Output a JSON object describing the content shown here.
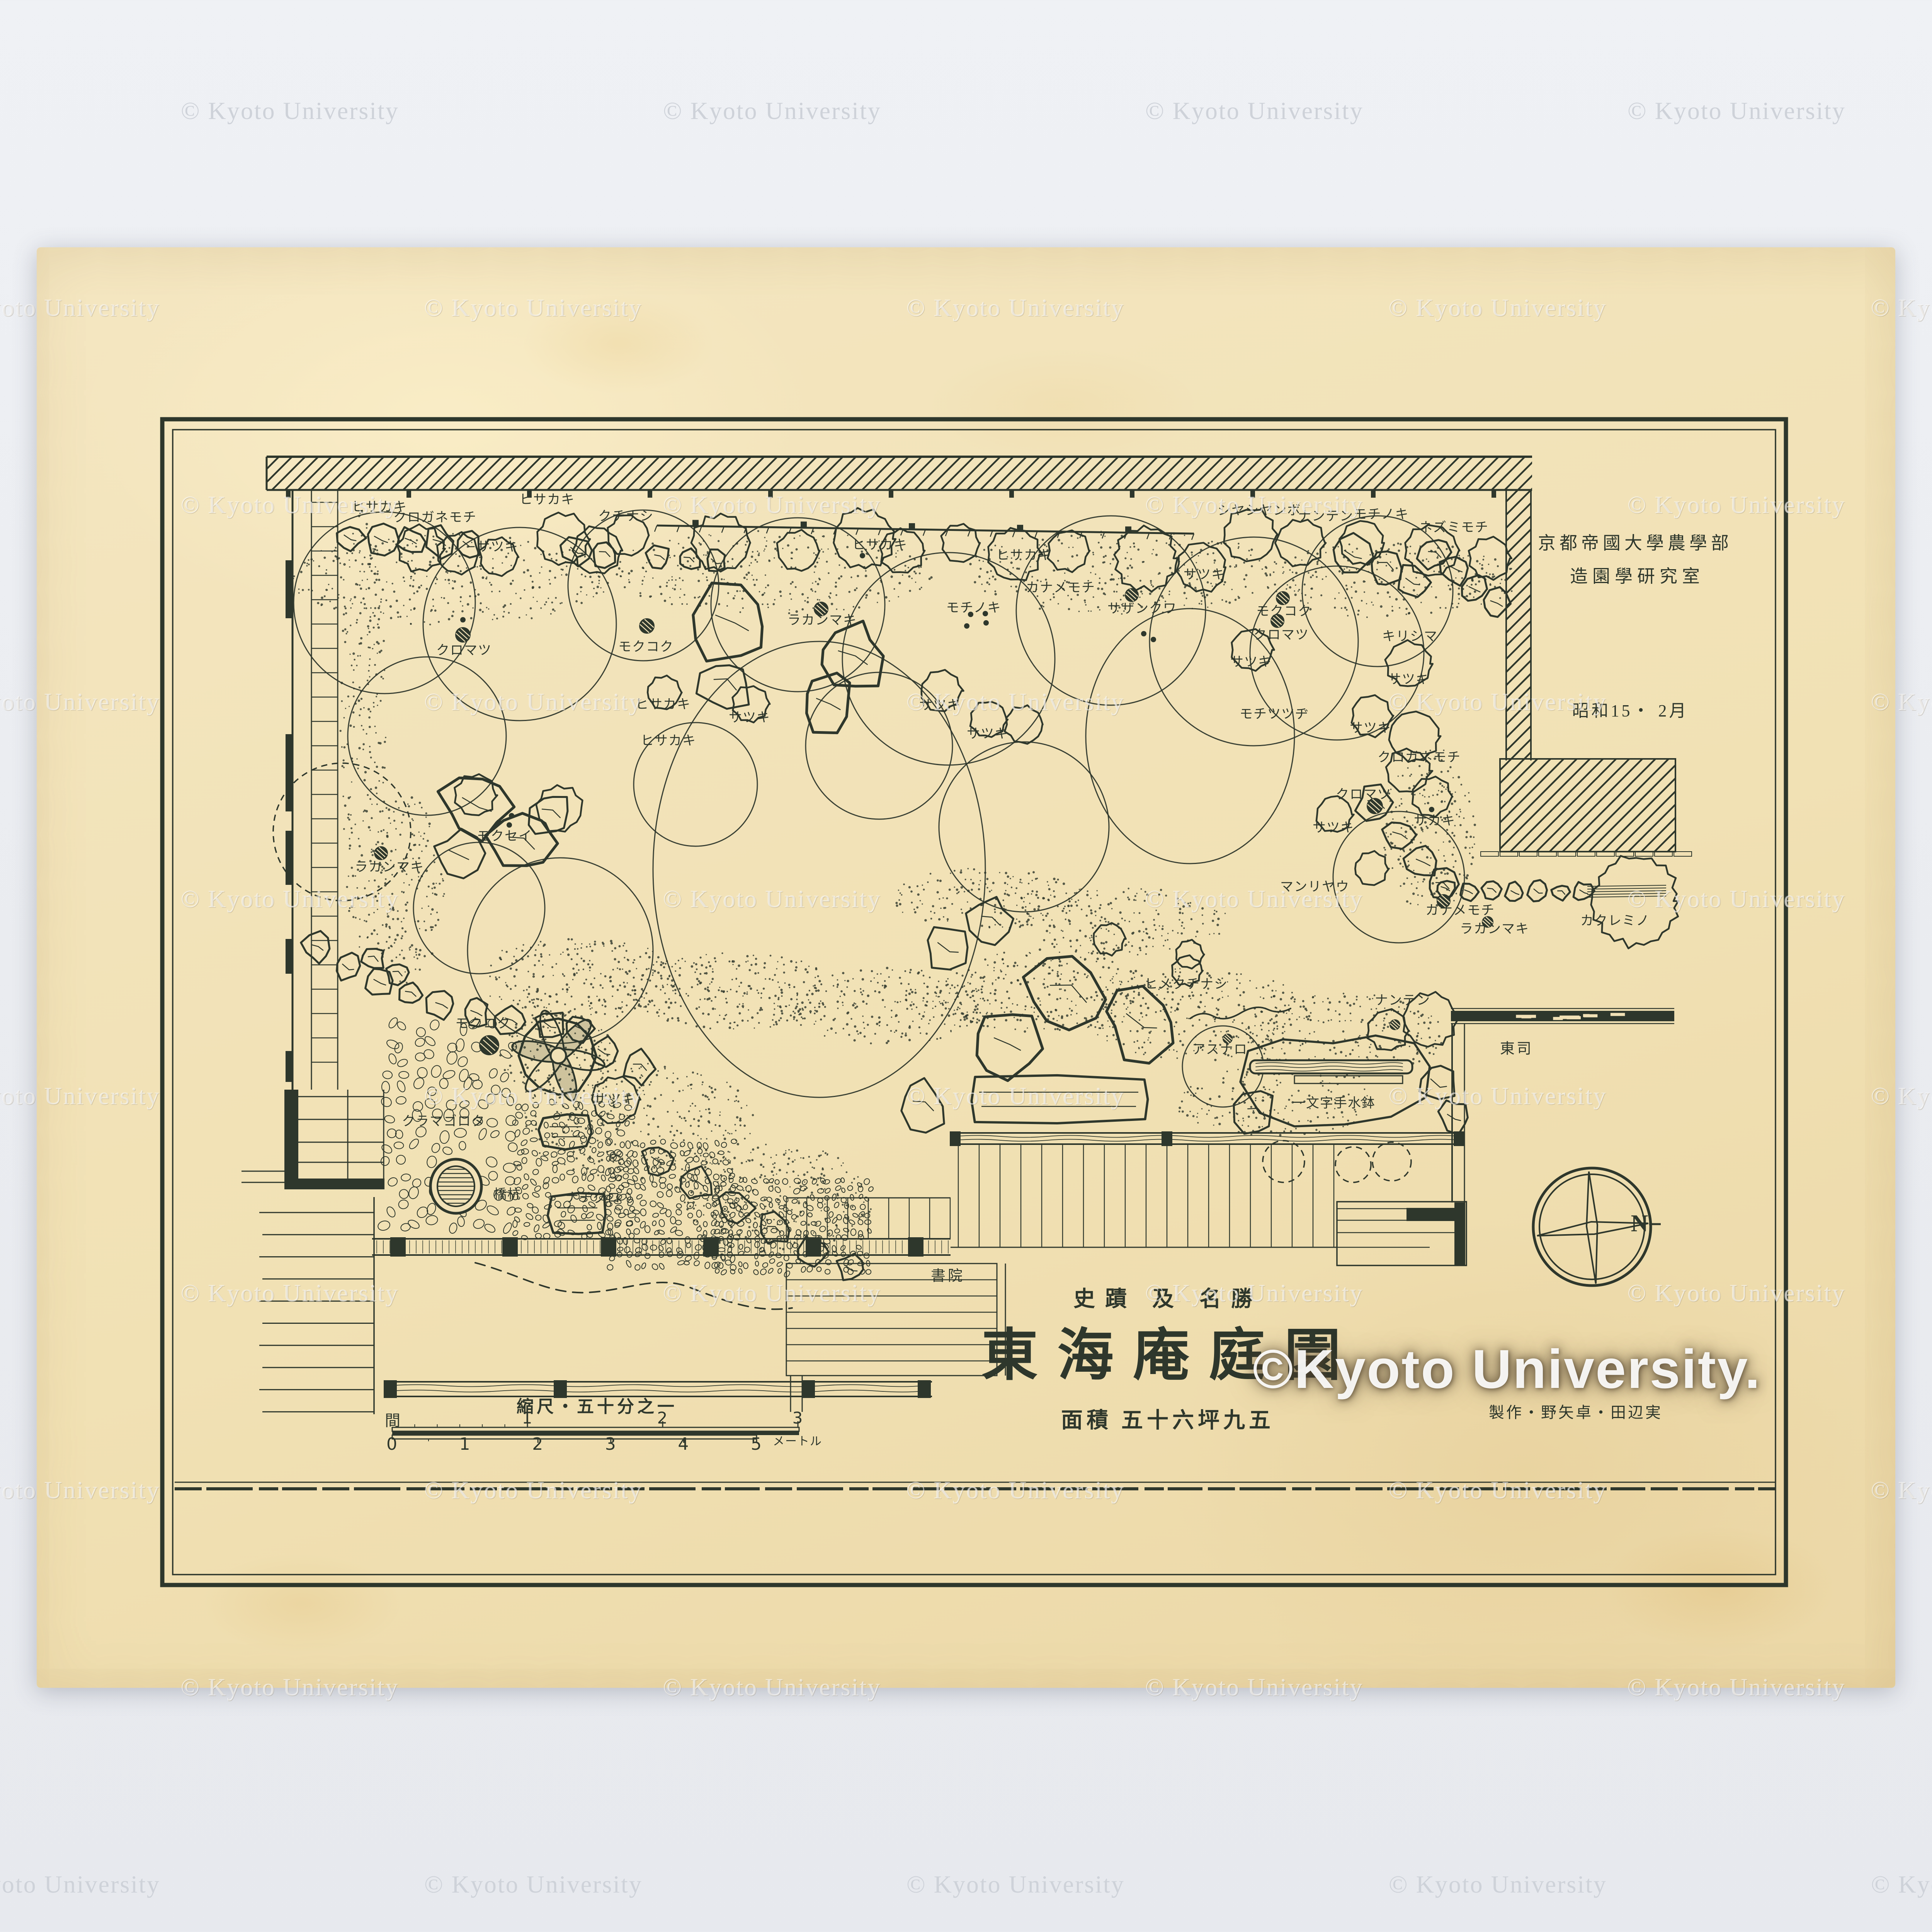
{
  "page": {
    "watermark": "© Kyoto University",
    "big_watermark": "©Kyoto University."
  },
  "colors": {
    "ink": "#2e372c",
    "paper": "#f1e1b6",
    "scan_bg": "#eff1f5",
    "watermark_white": "#ffffff"
  },
  "header": {
    "line1": "京都帝國大學農學部",
    "line2": "造園學研究室",
    "date": "昭和15・ 2月"
  },
  "title_block": {
    "superscript": "史蹟 及 名勝",
    "title": "東海庵庭園",
    "area_line": "面積 五十六坪九五",
    "credits": "製作・野矢卓・田辺実"
  },
  "rooms": {
    "shoin": "書院",
    "tosu": "東司"
  },
  "scale_bar": {
    "caption": "縮尺・五十分之一",
    "ken_label": "間",
    "meter_label": "メートル",
    "ken_ticks": [
      1,
      2,
      3
    ],
    "meter_ticks": [
      0,
      1,
      2,
      3,
      4,
      5
    ]
  },
  "compass": {
    "north_label": "N"
  },
  "plants": [
    [
      "ヒサカキ",
      982,
      1311
    ],
    [
      "ヒサカキ",
      1416,
      1292
    ],
    [
      "クロガネモチ",
      1126,
      1338
    ],
    [
      "クチナシ",
      1620,
      1335
    ],
    [
      "サツキ",
      1288,
      1414
    ],
    [
      "クロマツ",
      1201,
      1682
    ],
    [
      "モクコク",
      1672,
      1673
    ],
    [
      "ヒサカキ",
      1716,
      1822
    ],
    [
      "ヒサカキ",
      2277,
      1409
    ],
    [
      "ヒサカキ",
      2650,
      1436
    ],
    [
      "カナメモチ",
      2745,
      1520
    ],
    [
      "モチノキ",
      2520,
      1572
    ],
    [
      "ラカンマキ",
      2128,
      1604
    ],
    [
      "サツキ",
      2433,
      1824
    ],
    [
      "サツキ",
      1940,
      1856
    ],
    [
      "サツキ",
      2556,
      1898
    ],
    [
      "ヒサカキ",
      1730,
      1916
    ],
    [
      "シヤシヤンボ",
      3259,
      1320
    ],
    [
      "ナンテン",
      3431,
      1335
    ],
    [
      "モチノキ",
      3575,
      1330
    ],
    [
      "ネズミモチ",
      3763,
      1364
    ],
    [
      "サツキ",
      3117,
      1486
    ],
    [
      "サザンクワ",
      2956,
      1574
    ],
    [
      "モクコク",
      3323,
      1581
    ],
    [
      "クロマツ",
      3316,
      1642
    ],
    [
      "キリシマ",
      3649,
      1646
    ],
    [
      "サツキ",
      3238,
      1712
    ],
    [
      "サツキ",
      3646,
      1757
    ],
    [
      "モチツツヂ",
      3298,
      1847
    ],
    [
      "サツキ",
      3547,
      1883
    ],
    [
      "クロガネモチ",
      3673,
      1959
    ],
    [
      "クロマツ",
      3529,
      2055
    ],
    [
      "サカキ",
      3713,
      2123
    ],
    [
      "サツキ",
      3451,
      2141
    ],
    [
      "マンリヤウ",
      3403,
      2294
    ],
    [
      "カナメモチ",
      3779,
      2355
    ],
    [
      "ラカンマキ",
      3868,
      2403
    ],
    [
      "カクレミノ",
      4180,
      2382
    ],
    [
      "ナンテン",
      3630,
      2588
    ],
    [
      "ヒメクチナシ",
      3070,
      2546
    ],
    [
      "アスナロ",
      3157,
      2715
    ],
    [
      "モクセイ",
      1306,
      2163
    ],
    [
      "ラカンマキ",
      1008,
      2243
    ],
    [
      "モクコク",
      1250,
      2648
    ],
    [
      "サツキ",
      1590,
      2844
    ],
    [
      "クラマゴロタ",
      1148,
      2901
    ],
    [
      "橋杭",
      1313,
      3090
    ],
    [
      "ナチグロ",
      1535,
      3099
    ],
    [
      "一文字手水鉢",
      3452,
      2854
    ]
  ],
  "garden": {
    "smooth": [
      [
        995,
        1560,
        235
      ],
      [
        1345,
        1615,
        250
      ],
      [
        1665,
        1515,
        195
      ],
      [
        2065,
        1565,
        225
      ],
      [
        2455,
        1705,
        275
      ],
      [
        2875,
        1580,
        245
      ],
      [
        3245,
        1660,
        270
      ],
      [
        3565,
        1530,
        195
      ],
      [
        1105,
        1905,
        205
      ],
      [
        1450,
        2460,
        240
      ],
      [
        3080,
        1905,
        270,
        330
      ],
      [
        2650,
        2140,
        220
      ],
      [
        2120,
        2250,
        430,
        590
      ],
      [
        3460,
        1690,
        225
      ],
      [
        3165,
        2760,
        105
      ],
      [
        2275,
        1930,
        190
      ],
      [
        1800,
        2030,
        160
      ],
      [
        3620,
        2270,
        170
      ],
      [
        1240,
        2350,
        170
      ]
    ],
    "fluffy": [
      [
        1090,
        1420,
        58
      ],
      [
        1185,
        1432,
        52
      ],
      [
        1290,
        1442,
        48
      ],
      [
        1455,
        1395,
        66
      ],
      [
        1545,
        1425,
        60
      ],
      [
        1625,
        1385,
        52
      ],
      [
        1865,
        1405,
        72
      ],
      [
        2065,
        1425,
        52
      ],
      [
        2235,
        1395,
        76
      ],
      [
        2335,
        1425,
        56
      ],
      [
        2485,
        1405,
        48
      ],
      [
        2625,
        1435,
        66
      ],
      [
        2765,
        1425,
        52
      ],
      [
        2965,
        1445,
        80
      ],
      [
        3110,
        1468,
        62
      ],
      [
        3235,
        1385,
        66
      ],
      [
        3365,
        1405,
        60
      ],
      [
        3525,
        1405,
        56
      ],
      [
        3705,
        1425,
        66
      ],
      [
        3855,
        1445,
        52
      ],
      [
        1230,
        2058,
        52
      ],
      [
        1447,
        2092,
        58
      ],
      [
        1942,
        1822,
        46
      ],
      [
        2436,
        1788,
        52
      ],
      [
        2558,
        1862,
        46
      ],
      [
        3240,
        1682,
        52
      ],
      [
        3453,
        2108,
        46
      ],
      [
        3549,
        1852,
        52
      ],
      [
        3648,
        1718,
        58
      ],
      [
        3549,
        2248,
        42
      ],
      [
        3660,
        1905,
        64
      ],
      [
        3645,
        1995,
        56
      ],
      [
        3706,
        2062,
        50
      ],
      [
        1592,
        2846,
        60
      ],
      [
        3592,
        2667,
        52
      ],
      [
        3072,
        2512,
        38
      ],
      [
        1718,
        1792,
        42
      ],
      [
        2650,
        1875,
        48
      ],
      [
        3078,
        2470,
        36
      ],
      [
        2870,
        2430,
        40
      ],
      [
        4230,
        2332,
        112
      ],
      [
        3700,
        2640,
        68
      ]
    ],
    "dashed": [
      [
        885,
        2153,
        178
      ],
      [
        3322,
        3006,
        54
      ],
      [
        3502,
        3014,
        46
      ],
      [
        3602,
        3006,
        50
      ]
    ],
    "rocks": [
      [
        905,
        1392,
        36
      ],
      [
        985,
        1396,
        40
      ],
      [
        1062,
        1400,
        34
      ],
      [
        1136,
        1404,
        38
      ],
      [
        1212,
        1408,
        34
      ],
      [
        1492,
        1424,
        38
      ],
      [
        1564,
        1434,
        32
      ],
      [
        1706,
        1442,
        30
      ],
      [
        1782,
        1448,
        30
      ],
      [
        1852,
        1452,
        28
      ],
      [
        3500,
        1435,
        52
      ],
      [
        3585,
        1465,
        46
      ],
      [
        3655,
        1505,
        42
      ],
      [
        3712,
        1435,
        38
      ],
      [
        3766,
        1472,
        40
      ],
      [
        3815,
        1525,
        34
      ],
      [
        3872,
        1562,
        36
      ],
      [
        1232,
        2082,
        88
      ],
      [
        1348,
        2182,
        78
      ],
      [
        1185,
        2212,
        62
      ],
      [
        1425,
        2105,
        55
      ],
      [
        1892,
        1612,
        100
      ],
      [
        2205,
        1702,
        88
      ],
      [
        1875,
        1772,
        68
      ],
      [
        2142,
        1822,
        72
      ],
      [
        2452,
        2452,
        62
      ],
      [
        2562,
        2382,
        54
      ],
      [
        2762,
        2572,
        110
      ],
      [
        2952,
        2642,
        92
      ],
      [
        2605,
        2702,
        80
      ],
      [
        2388,
        2862,
        62
      ],
      [
        820,
        2452,
        36
      ],
      [
        900,
        2502,
        34
      ],
      [
        982,
        2542,
        36
      ],
      [
        1062,
        2572,
        32
      ],
      [
        1142,
        2602,
        36
      ],
      [
        1232,
        2622,
        34
      ],
      [
        1322,
        2642,
        36
      ],
      [
        1422,
        2652,
        38
      ],
      [
        1502,
        2662,
        34
      ],
      [
        1562,
        2722,
        36
      ],
      [
        1655,
        2762,
        40
      ],
      [
        1702,
        3002,
        40
      ],
      [
        1802,
        3062,
        42
      ],
      [
        1902,
        3122,
        44
      ],
      [
        2002,
        3182,
        40
      ],
      [
        2102,
        3242,
        38
      ],
      [
        2202,
        3282,
        36
      ],
      [
        3740,
        2300,
        26
      ],
      [
        3800,
        2308,
        24
      ],
      [
        3860,
        2304,
        26
      ],
      [
        3920,
        2310,
        24
      ],
      [
        3980,
        2306,
        26
      ],
      [
        4040,
        2310,
        22
      ],
      [
        4098,
        2308,
        24
      ],
      [
        3560,
        2082,
        50
      ],
      [
        3622,
        2162,
        44
      ],
      [
        3682,
        2232,
        42
      ],
      [
        3732,
        2292,
        40
      ],
      [
        3250,
        2880,
        52
      ],
      [
        3722,
        2802,
        48
      ],
      [
        3762,
        2892,
        40
      ],
      [
        965,
        2482,
        30
      ],
      [
        1028,
        2520,
        28
      ]
    ],
    "slabs": [
      [
        2520,
        2790,
        2960,
        2900
      ],
      [
        1408,
        2890,
        1520,
        2968
      ],
      [
        1428,
        3094,
        1560,
        3190
      ]
    ],
    "trunks": [
      [
        1198,
        1643,
        20
      ],
      [
        1674,
        1620,
        20
      ],
      [
        2125,
        1576,
        19
      ],
      [
        2929,
        1540,
        18
      ],
      [
        3320,
        1548,
        18
      ],
      [
        3306,
        1607,
        18
      ],
      [
        3558,
        2086,
        21
      ],
      [
        3736,
        2332,
        18
      ],
      [
        3850,
        2386,
        15
      ],
      [
        1266,
        2705,
        26
      ],
      [
        986,
        2208,
        18
      ],
      [
        3177,
        2688,
        13
      ],
      [
        3610,
        2652,
        14
      ]
    ],
    "dots": [
      [
        2512,
        1590
      ],
      [
        2550,
        1588
      ],
      [
        2502,
        1620
      ],
      [
        2552,
        1612
      ],
      [
        1291,
        2128
      ],
      [
        1324,
        2111
      ],
      [
        1318,
        2135
      ],
      [
        3705,
        2095
      ],
      [
        2232,
        1438
      ],
      [
        1198,
        1604
      ],
      [
        2960,
        1640
      ],
      [
        2985,
        1655
      ]
    ],
    "stipple": [
      [
        1500,
        2530,
        260,
        110,
        260
      ],
      [
        1900,
        2565,
        280,
        100,
        260
      ],
      [
        2300,
        2605,
        260,
        100,
        240
      ],
      [
        2700,
        2565,
        280,
        110,
        260
      ],
      [
        3100,
        2625,
        300,
        120,
        280
      ],
      [
        3480,
        2680,
        260,
        110,
        240
      ],
      [
        2900,
        2385,
        280,
        90,
        200
      ],
      [
        2550,
        2325,
        240,
        80,
        170
      ],
      [
        1650,
        2900,
        300,
        160,
        300
      ],
      [
        2000,
        3100,
        260,
        140,
        260
      ],
      [
        1160,
        1500,
        420,
        120,
        330
      ],
      [
        2000,
        1480,
        420,
        110,
        300
      ],
      [
        2900,
        1480,
        420,
        110,
        300
      ],
      [
        3600,
        1500,
        330,
        100,
        240
      ],
      [
        940,
        1900,
        60,
        580,
        240
      ],
      [
        3300,
        2850,
        260,
        90,
        170
      ],
      [
        1445,
        2732,
        150,
        120,
        150
      ],
      [
        3700,
        2150,
        120,
        220,
        200
      ],
      [
        1050,
        2300,
        100,
        250,
        180
      ]
    ],
    "pebbles": [
      [
        1005,
        2660,
        1330,
        3200,
        26
      ],
      [
        1340,
        2860,
        1640,
        3200,
        16
      ],
      [
        1580,
        2960,
        1900,
        3280,
        15
      ],
      [
        1850,
        3060,
        2260,
        3300,
        14
      ]
    ]
  }
}
